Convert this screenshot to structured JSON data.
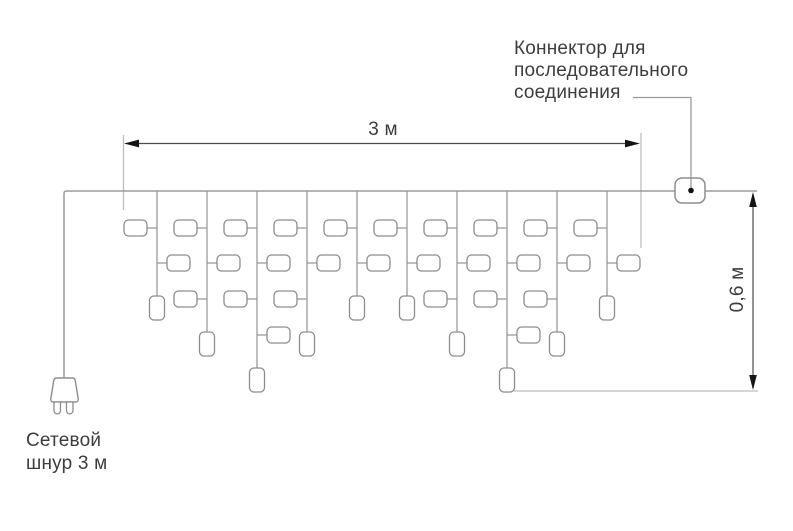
{
  "labels": {
    "connector": {
      "line1": "Коннектор для",
      "line2": "последовательного",
      "line3": "соединения"
    },
    "width_dimension": "3 м",
    "height_dimension": "0,6 м",
    "power_cord": {
      "line1": "Сетевой",
      "line2": "шнур 3 м"
    }
  },
  "colors": {
    "background": "#ffffff",
    "wire": "#9b9b9b",
    "lamp_stroke": "#8d8d8d",
    "lamp_fill": "#ffffff",
    "extension_line": "#bcbcbc",
    "dimension_line": "#4d4d4d",
    "arrow": "#141414",
    "text": "#3d3d3d",
    "connector_dot": "#111111"
  },
  "garland": {
    "wire_y": 191,
    "wire_start_x": 64,
    "wire_end_x": 757,
    "drop_spacing": 50,
    "drops": [
      {
        "x": 157,
        "end_level": 3
      },
      {
        "x": 207,
        "end_level": 4
      },
      {
        "x": 257,
        "end_level": 5
      },
      {
        "x": 307,
        "end_level": 4
      },
      {
        "x": 357,
        "end_level": 3
      },
      {
        "x": 407,
        "end_level": 3
      },
      {
        "x": 457,
        "end_level": 4
      },
      {
        "x": 507,
        "end_level": 5
      },
      {
        "x": 557,
        "end_level": 4
      },
      {
        "x": 607,
        "end_level": 3
      }
    ],
    "lamp_row_tops": [
      220,
      255,
      291,
      327
    ],
    "end_lamp_top_by_level": {
      "3": 296,
      "4": 332,
      "5": 368
    }
  }
}
